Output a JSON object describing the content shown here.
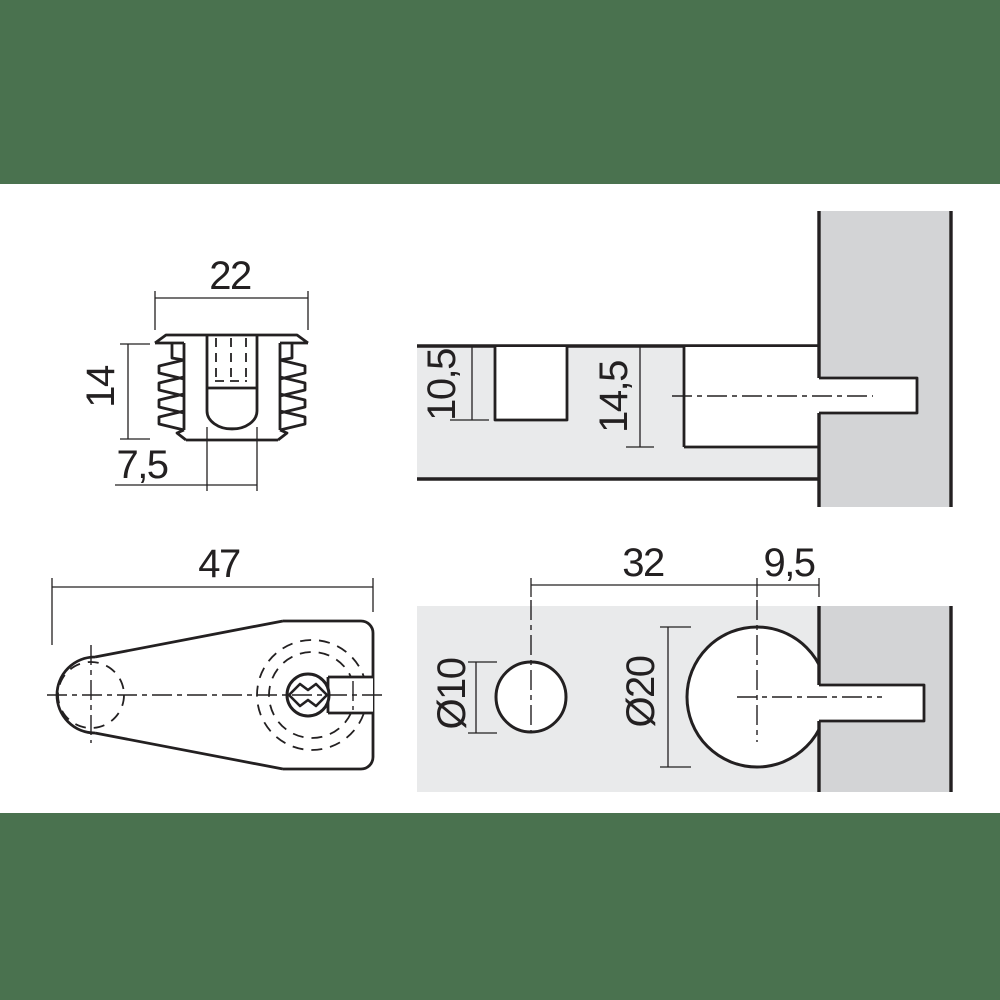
{
  "colors": {
    "band_green": "#4a724f",
    "panel_light": "#e9eaeb",
    "panel_dark": "#d3d4d6",
    "line": "#232021"
  },
  "views": {
    "front": {
      "width": "22",
      "height": "14",
      "slot_width": "7,5"
    },
    "section": {
      "top_hole_depth": "10,5",
      "cam_hole_depth": "14,5"
    },
    "side": {
      "length": "47"
    },
    "drilling": {
      "hole_distance": "32",
      "edge_distance": "9,5",
      "pilot_hole_dia": "Ø10",
      "cam_hole_dia": "Ø20"
    }
  }
}
